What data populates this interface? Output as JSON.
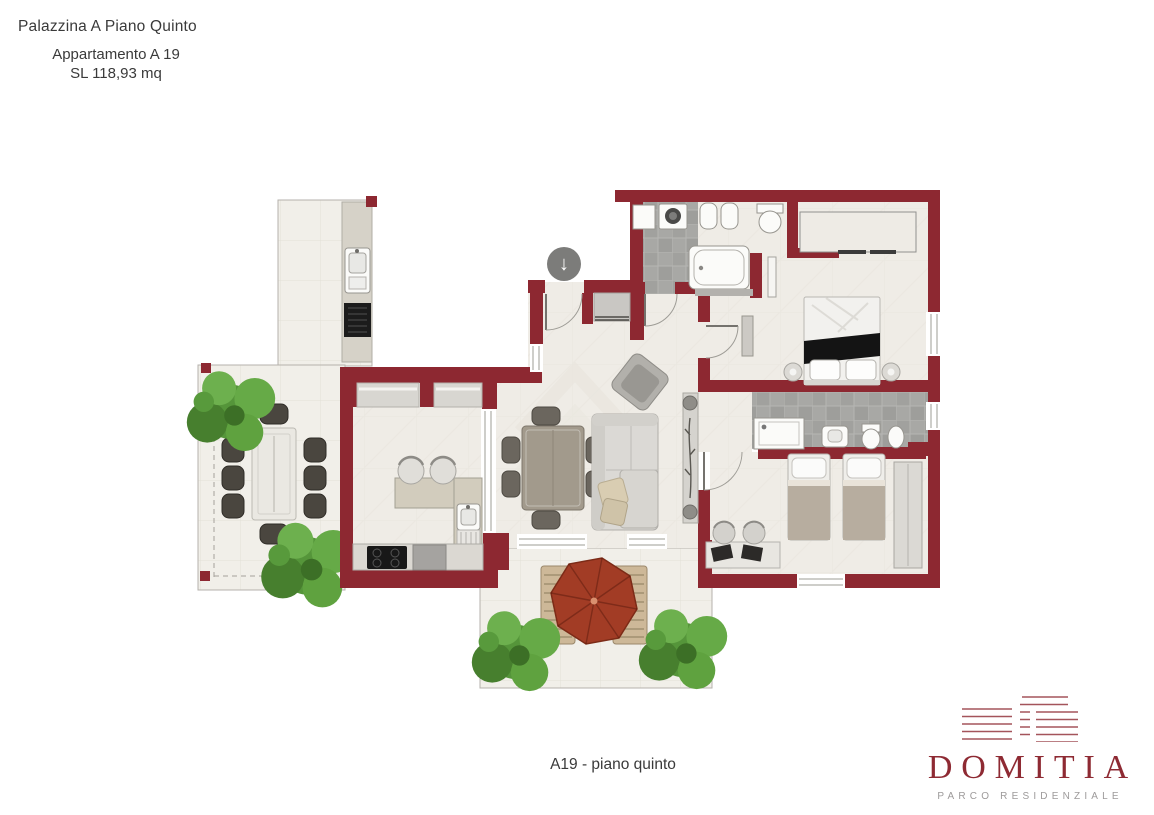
{
  "header": {
    "building": "Palazzina A Piano Quinto",
    "apartment": "Appartamento A 19",
    "surface": "SL 118,93 mq"
  },
  "caption": "A19 - piano quinto",
  "brand": {
    "name": "DOMITIA",
    "tagline": "PARCO RESIDENZIALE",
    "logo_icon": "building-facade-lines-icon"
  },
  "entrance": {
    "icon": "arrow-down-icon",
    "glyph": "↓"
  },
  "colors": {
    "wall": "#8d2831",
    "brand": "#8e2a33",
    "tagline": "#9d9a9a",
    "umbrella": "#a23c25",
    "plant": "#5f9e3e",
    "floor": "#efece6",
    "tile": "#a6a6a3",
    "terrace": "#f1efe9",
    "text": "#3a3a3a"
  }
}
